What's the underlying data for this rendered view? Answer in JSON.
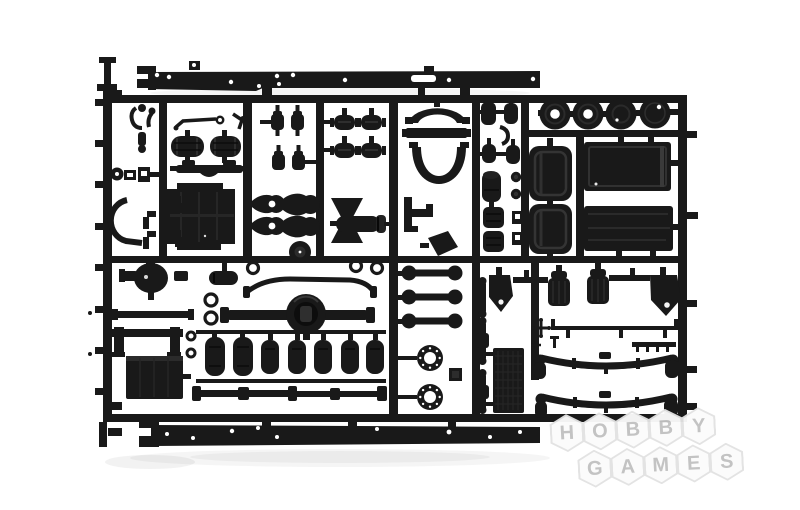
{
  "photo": {
    "description": "Black injection-molded plastic model kit sprue with truck chassis parts photographed on a white background",
    "parts_visible": [
      "chassis-rail x2",
      "wheel-disc x4",
      "cab-seat x2",
      "cab-roof-panel x2",
      "fuel-tank x2",
      "cab-floor-panel",
      "front-axle-housing",
      "rear-axle-with-differential",
      "air-tank x7",
      "drive-shaft x2",
      "leaf-spring x2",
      "leaf-spring-link x3",
      "brake-drum-ring x2",
      "shock-absorber x3",
      "radiator-core",
      "battery-box",
      "mudflap-bracket x2",
      "air-filter x2",
      "exhaust-muffler",
      "steering-linkage",
      "brake-chamber x4",
      "wheel-hub x4",
      "engine-mount x4",
      "sprue-runner-frame"
    ]
  },
  "colors": {
    "bg": "#ffffff",
    "ink": "#191919",
    "hex_fill": "#fbfbfb",
    "hex_border": "#e2e2e2",
    "letter": "#c1c1c1"
  },
  "watermark": {
    "text": "HOBBY GAMES",
    "row1": [
      "H",
      "O",
      "B",
      "B",
      "Y"
    ],
    "row2": [
      "G",
      "A",
      "M",
      "E",
      "S"
    ]
  }
}
